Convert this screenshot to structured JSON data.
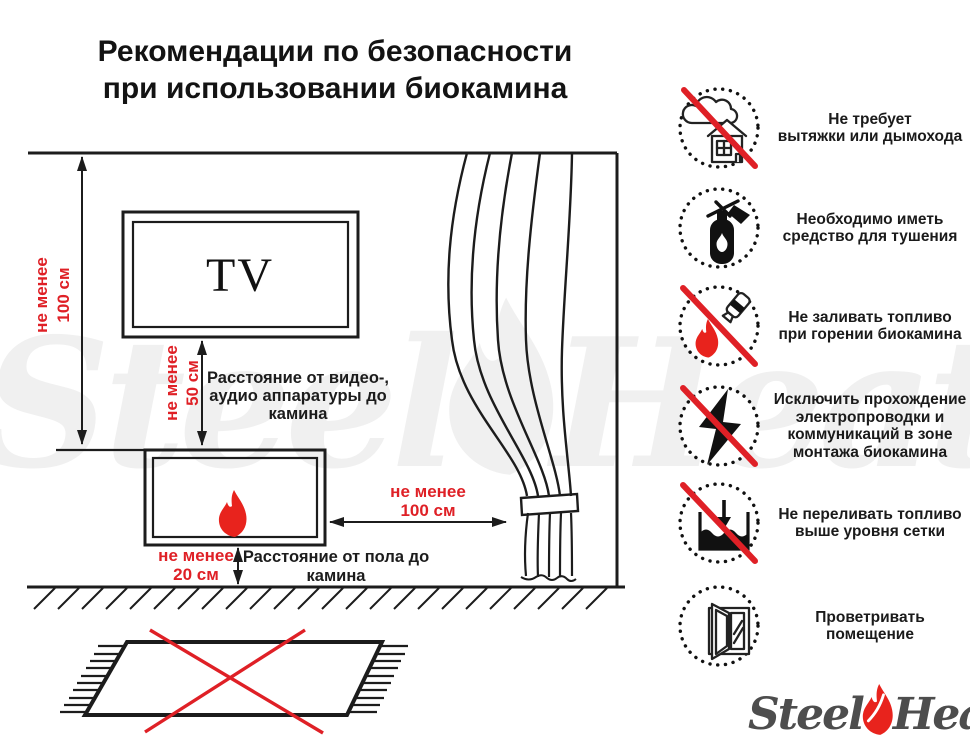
{
  "title": {
    "line1": "Рекомендации по безопасности",
    "line2": "при использовании биокамина"
  },
  "diagram": {
    "tv_label": "TV",
    "dim_wall_to_fireplace": {
      "l1": "не менее",
      "l2": "100 см"
    },
    "dim_tv_to_fireplace": {
      "l1": "не менее",
      "l2": "50 см"
    },
    "caption_tv": {
      "l1": "Расстояние от видео-,",
      "l2": "аудио аппаратуры до",
      "l3": "камина"
    },
    "dim_floor_to_fireplace": {
      "l1": "не менее",
      "l2": "20 см"
    },
    "caption_floor": {
      "l1": "Расстояние от пола до",
      "l2": "камина"
    },
    "dim_fireplace_to_curtain": {
      "l1": "не менее",
      "l2": "100 см"
    }
  },
  "rules": [
    {
      "name": "no-chimney-needed",
      "crossed": true,
      "lines": [
        "Не требует",
        "вытяжки или дымохода"
      ]
    },
    {
      "name": "extinguisher-required",
      "crossed": false,
      "lines": [
        "Необходимо иметь",
        "средство для тушения"
      ]
    },
    {
      "name": "no-refuel-while-burning",
      "crossed": true,
      "lines": [
        "Не заливать топливо",
        "при горении биокамина"
      ]
    },
    {
      "name": "no-electrical-wiring-in-zone",
      "crossed": true,
      "lines": [
        "Исключить прохождение",
        "электропроводки и",
        "коммуникаций в зоне",
        "монтажа биокамина"
      ]
    },
    {
      "name": "no-overfill-above-grid",
      "crossed": true,
      "lines": [
        "Не переливать топливо",
        "выше уровня сетки"
      ]
    },
    {
      "name": "ventilate-room",
      "crossed": false,
      "lines": [
        "Проветривать",
        "помещение"
      ]
    }
  ],
  "logo": {
    "word1": "Steel",
    "word2": "Heat"
  },
  "watermark": {
    "word1": "Steel",
    "word2": "Heat"
  },
  "colors": {
    "accent_red": "#df2026",
    "flame_red": "#e8231d",
    "line_black": "#1c1c1c",
    "logo_gray": "#4d4d4d"
  }
}
